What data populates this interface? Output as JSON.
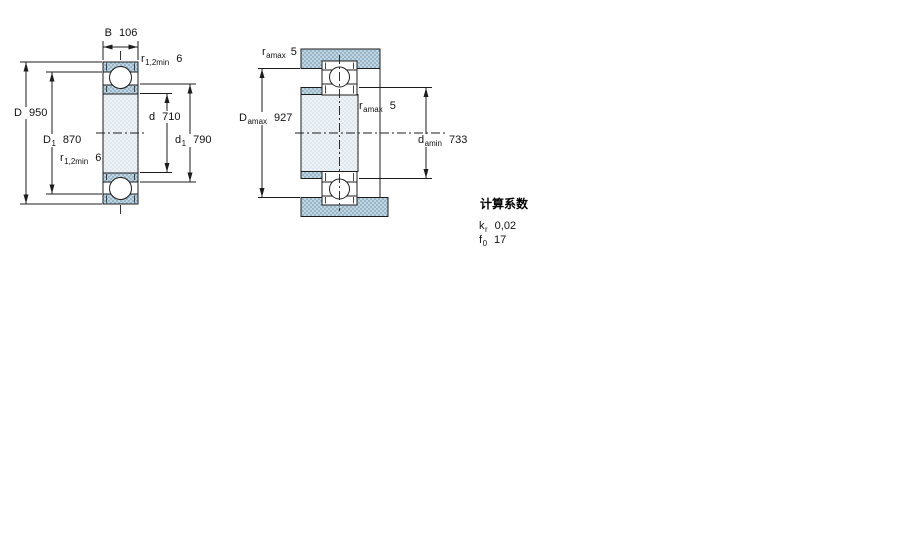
{
  "left_drawing": {
    "description": "bearing cross-section",
    "labels": {
      "B": {
        "symbol": "B",
        "value": "106"
      },
      "r_top": {
        "symbol": "r",
        "sub": "1,2min",
        "value": "6"
      },
      "D": {
        "symbol": "D",
        "value": "950"
      },
      "D1": {
        "symbol": "D",
        "sub": "1",
        "value": "870"
      },
      "r_bottom": {
        "symbol": "r",
        "sub": "1,2min",
        "value": "6"
      },
      "d": {
        "symbol": "d",
        "value": "710"
      },
      "d1": {
        "symbol": "d",
        "sub": "1",
        "value": "790"
      }
    }
  },
  "right_drawing": {
    "description": "abutment and fillet dimensions",
    "labels": {
      "r_amax_top": {
        "symbol": "r",
        "sub": "amax",
        "value": "5"
      },
      "D_amax": {
        "symbol": "D",
        "sub": "amax",
        "value": "927"
      },
      "r_amax_mid": {
        "symbol": "r",
        "sub": "amax",
        "value": "5"
      },
      "d_amin": {
        "symbol": "d",
        "sub": "amin",
        "value": "733"
      }
    }
  },
  "calculation_factors": {
    "title": "计算系数",
    "rows": [
      {
        "symbol": "k",
        "sub": "r",
        "value": "0,02"
      },
      {
        "symbol": "f",
        "sub": "0",
        "value": "17"
      }
    ]
  },
  "colors": {
    "line": "#1c1c1c",
    "steel_blue": "#aec9da",
    "light_fill": "#e9eff4",
    "background": "#ffffff"
  }
}
